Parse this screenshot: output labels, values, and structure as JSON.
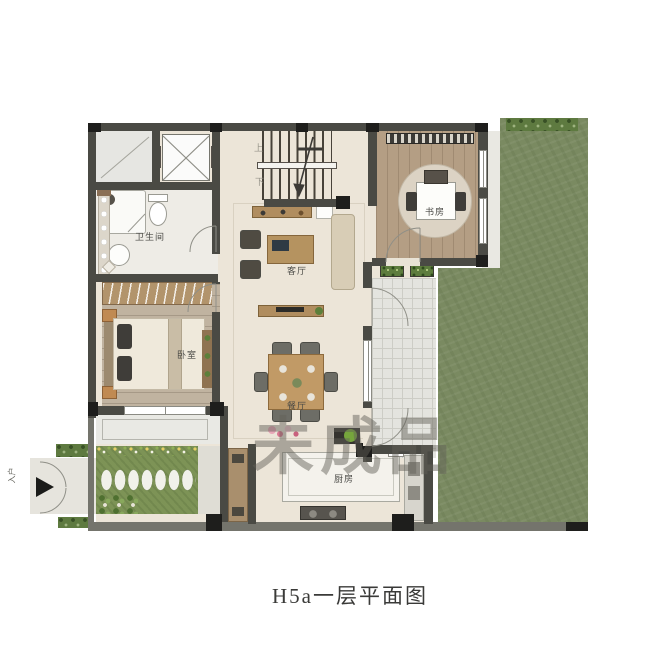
{
  "title": {
    "caption": "H5a一层平面图"
  },
  "watermark": {
    "text": "未成品"
  },
  "labels": {
    "bathroom": "卫生间",
    "living_room": "客厅",
    "bedroom": "卧室",
    "study": "书房",
    "dining_room": "餐厅",
    "kitchen": "厨房",
    "stairs_up": "上",
    "stairs_down": "下",
    "entrance": "入户"
  },
  "colors": {
    "wall": "#4a4a44",
    "floor": "#ece5d8",
    "lawn": "#7a8a61",
    "hedge": "#5e7a40",
    "garden": "#7d9356",
    "wood_bedroom": "#c0b3a0",
    "wood_study": "#b49e84",
    "tile": "#e4e4df"
  }
}
